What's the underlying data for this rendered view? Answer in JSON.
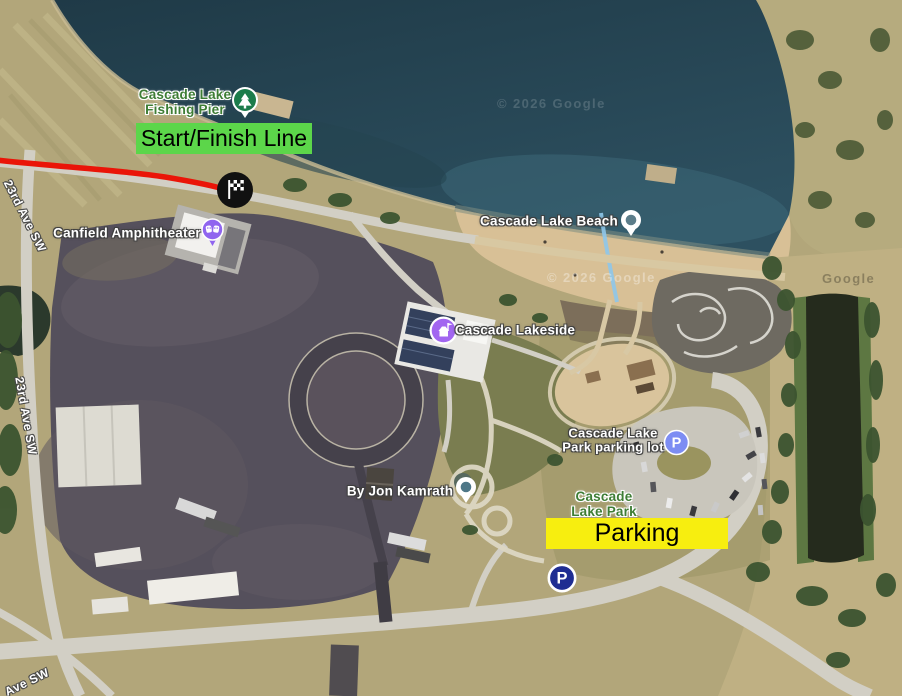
{
  "annotations": {
    "start_finish": {
      "label": "Start/Finish Line",
      "bg_color": "#5cd64a"
    },
    "parking": {
      "label": "Parking",
      "bg_color": "#f7ee0f"
    },
    "route_color": "#ea1508",
    "marker_bg": "#111111"
  },
  "pois": {
    "fishing_pier": {
      "line1": "Cascade Lake",
      "line2": "Fishing Pier",
      "color": "#3e7d35"
    },
    "beach": {
      "label": "Cascade Lake Beach"
    },
    "amphitheater": {
      "label": "Canfield Amphitheater"
    },
    "lakeside": {
      "label": "Cascade Lakeside"
    },
    "parking_lot": {
      "line1": "Cascade Lake",
      "line2": "Park parking lot"
    },
    "park": {
      "line1": "Cascade",
      "line2": "Lake Park",
      "color": "#3e7d35"
    },
    "photo_attribution": {
      "label": "By Jon Kamrath"
    },
    "parking_glyph": "P"
  },
  "icons": {
    "fishing_pier": "park-tree-icon",
    "beach": "location-pin-icon",
    "amphitheater": "theater-masks-pin-icon",
    "lakeside": "attraction-circle-icon",
    "parking_lot": "parking-circle-icon",
    "photo_attribution": "location-pin-icon",
    "start_finish_marker": "checkered-flag-icon",
    "parking_sign": "parking-sign-icon"
  },
  "streets": {
    "left_upper": "23rd Ave SW",
    "left_lower": "23rd Ave SW",
    "bottom": "Ave SW"
  },
  "watermarks": {
    "on_lake": "© 2026 Google",
    "on_beach": "© 2026 Google",
    "right_edge": "Google"
  }
}
